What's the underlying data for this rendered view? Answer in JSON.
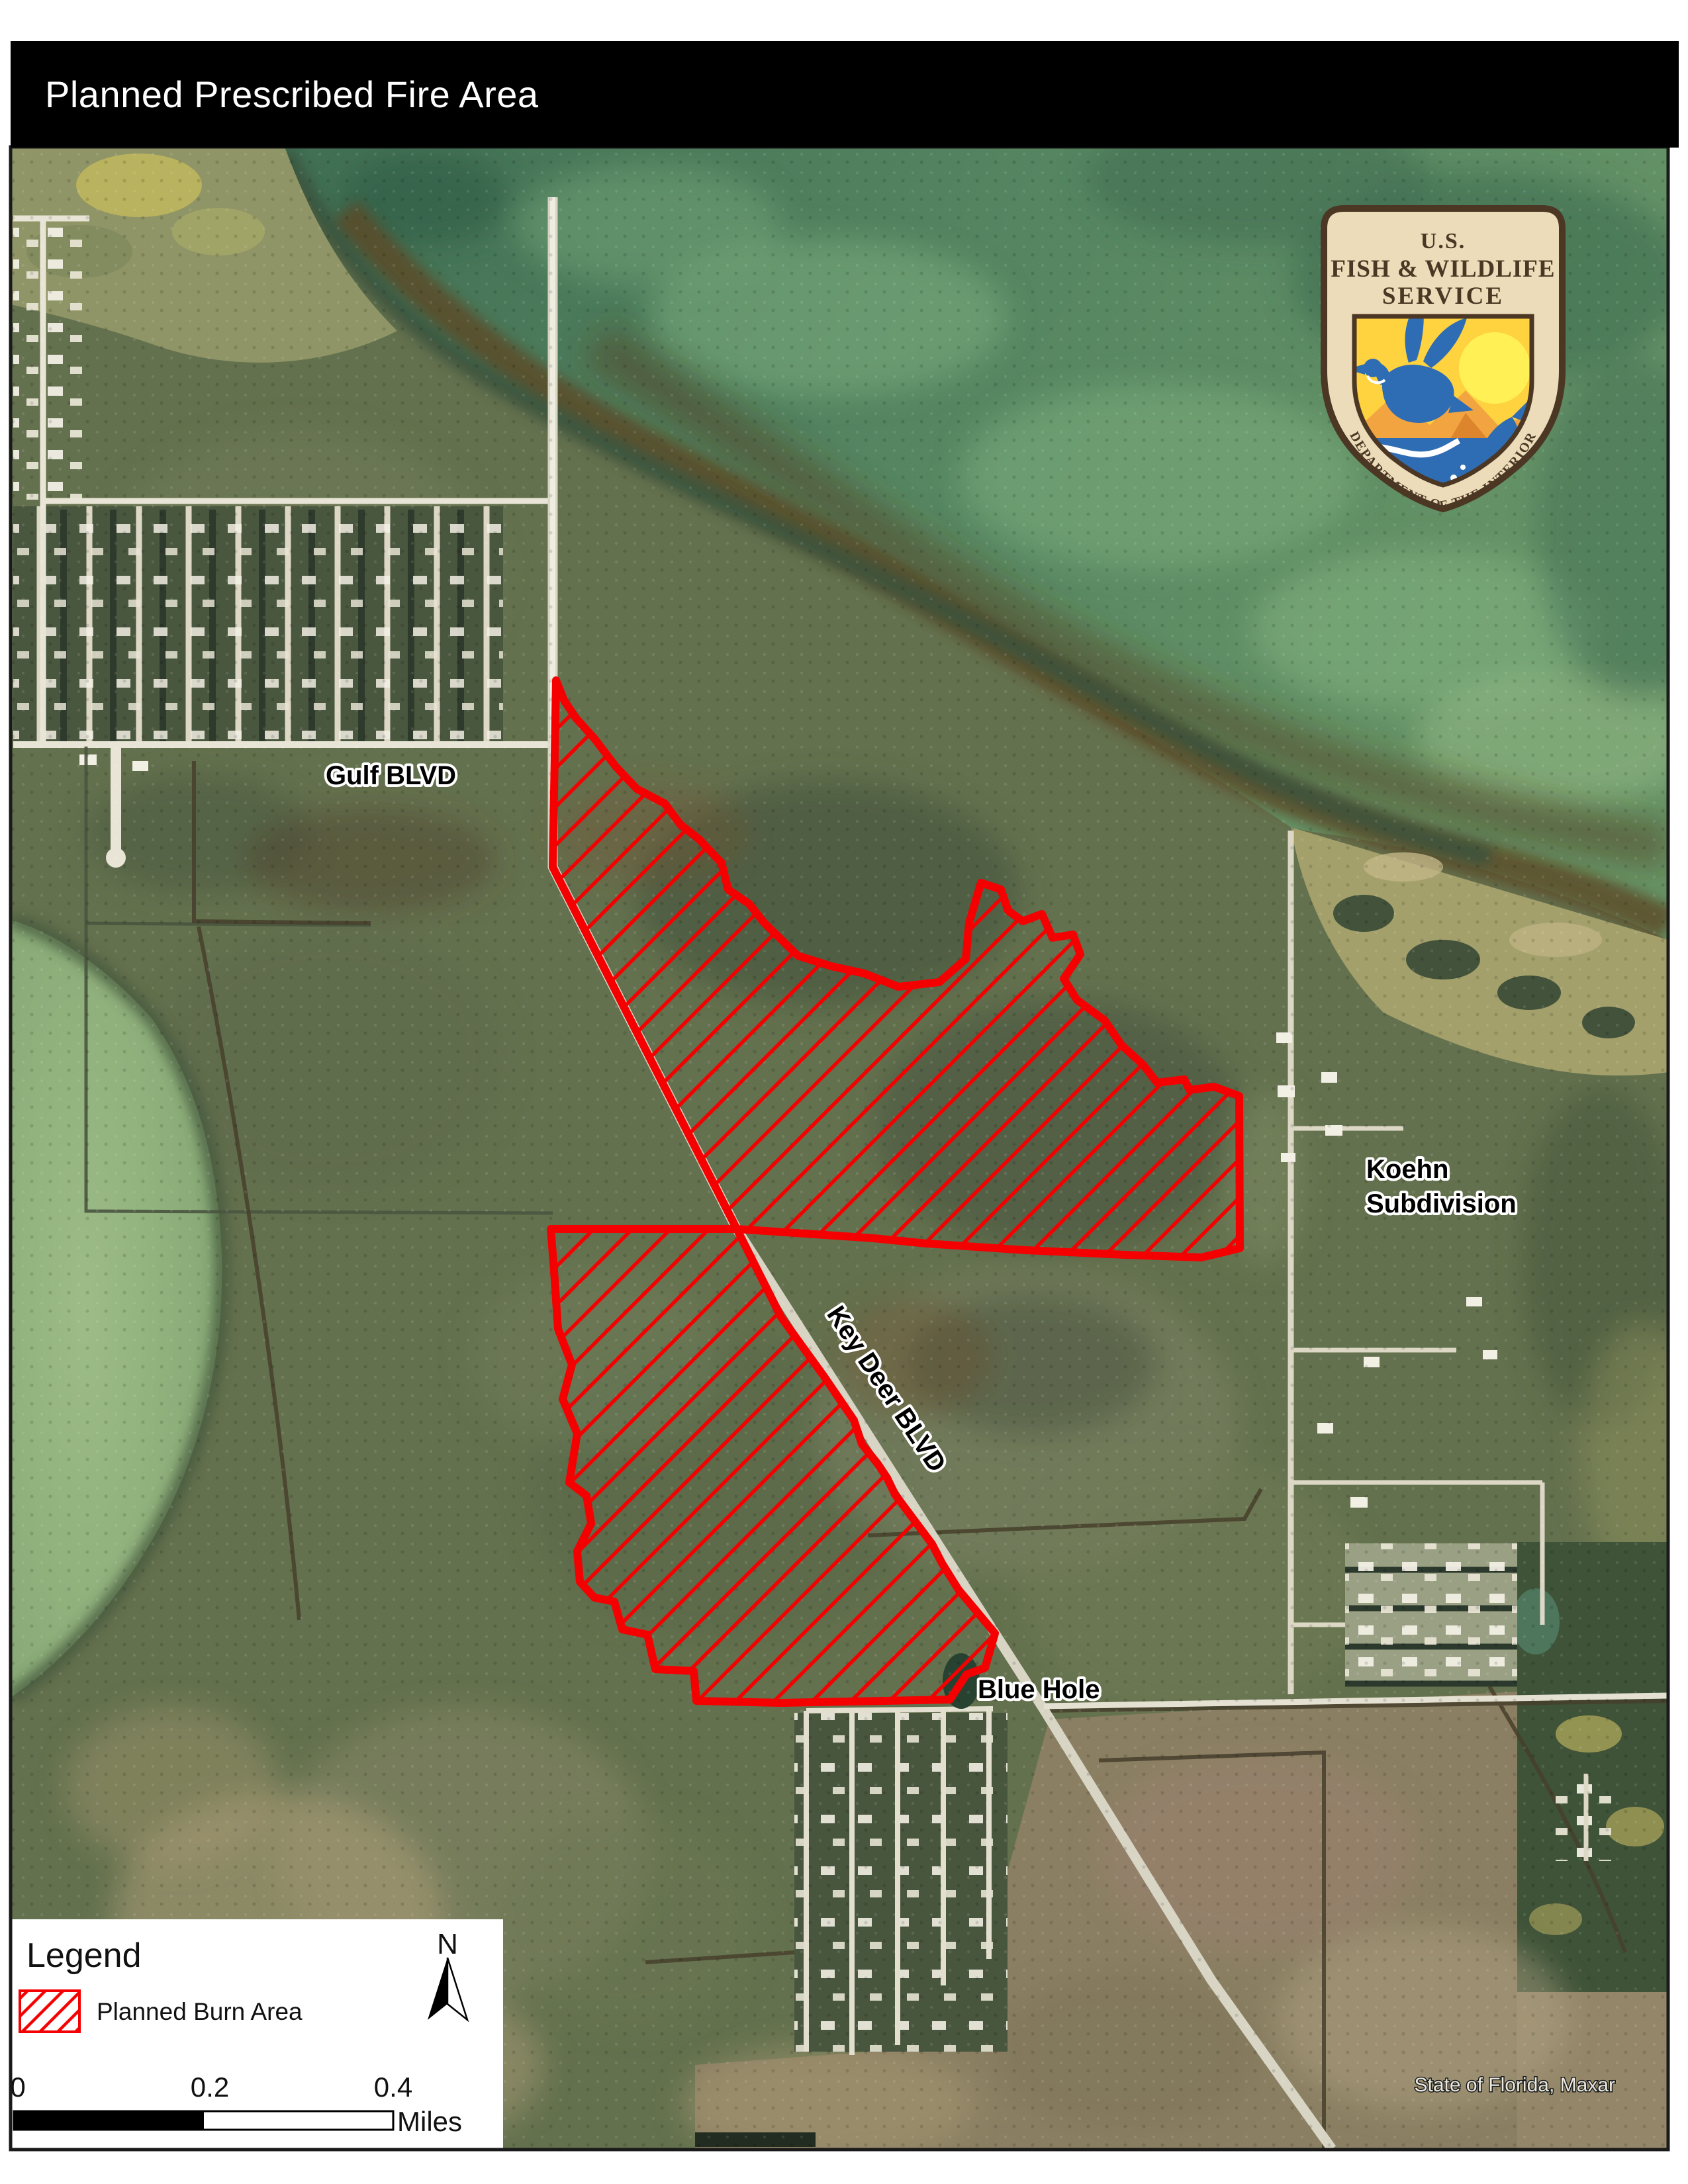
{
  "title": "Planned Prescribed Fire Area",
  "logo": {
    "line1": "U.S.",
    "line2": "FISH & WILDLIFE",
    "line3": "SERVICE",
    "arc": "DEPARTMENT OF THE INTERIOR"
  },
  "map_labels": {
    "gulf_blvd": "Gulf BLVD",
    "koehn_line1": "Koehn",
    "koehn_line2": "Subdivision",
    "key_deer_blvd": "Key Deer BLVD",
    "blue_hole": "Blue Hole"
  },
  "attribution": "State of Florida, Maxar",
  "legend": {
    "heading": "Legend",
    "burn_area": "Planned Burn Area",
    "north": "N"
  },
  "scale": {
    "t0": "0",
    "t1": "0.2",
    "t2": "0.4",
    "unit": "Miles"
  },
  "colors": {
    "burn_area_red": "#f40000",
    "title_bar_black": "#000000",
    "shield_cream": "#ecdcba",
    "shield_brown": "#4b3723",
    "water_green": "#4d7a5c",
    "bay_green": "#8fae7b"
  }
}
